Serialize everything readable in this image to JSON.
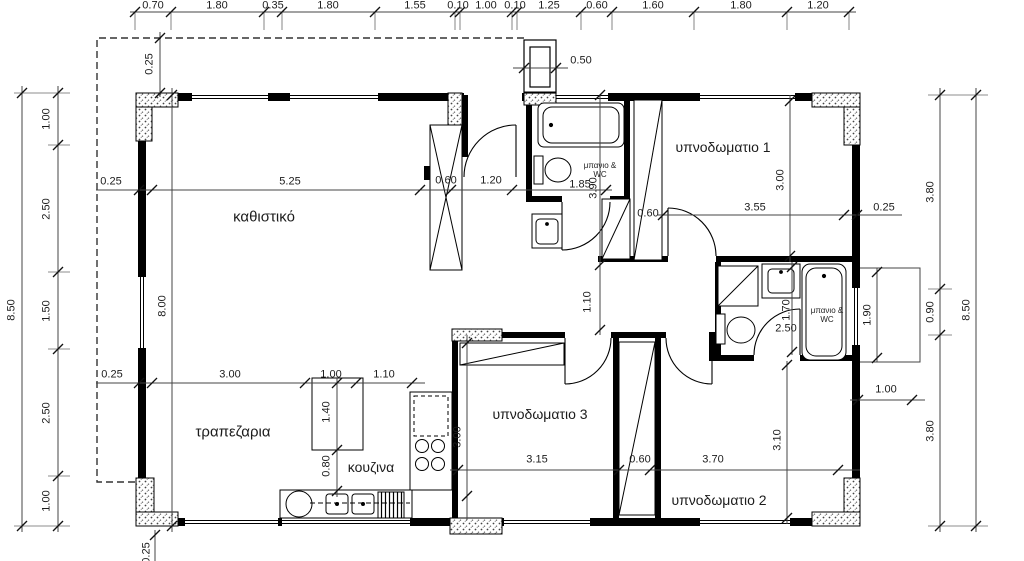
{
  "drawing": {
    "kind": "floor-plan",
    "language": "greek"
  },
  "room_labels": [
    {
      "t": "καθιστικό",
      "x": 264,
      "y": 217,
      "s": 15
    },
    {
      "t": "τραπεζαρια",
      "x": 233,
      "y": 432,
      "s": 15
    },
    {
      "t": "κουζινα",
      "x": 371,
      "y": 467,
      "s": 14
    },
    {
      "t": "υπνοδωματιο 1",
      "x": 723,
      "y": 147,
      "s": 14
    },
    {
      "t": "υπνοδωματιο 2",
      "x": 719,
      "y": 500,
      "s": 14
    },
    {
      "t": "υπνοδωματιο 3",
      "x": 540,
      "y": 414,
      "s": 14
    },
    {
      "t": "μπανιο & WC",
      "x": 600,
      "y": 170,
      "s": 8,
      "w": 46
    },
    {
      "t": "μπανιο & WC",
      "x": 827,
      "y": 315,
      "s": 8,
      "w": 46
    }
  ],
  "dimension_labels": {
    "top_chain": [
      {
        "t": "0.70",
        "x": 153,
        "y": 6
      },
      {
        "t": "1.80",
        "x": 217,
        "y": 6
      },
      {
        "t": "0.35",
        "x": 273,
        "y": 6
      },
      {
        "t": "1.80",
        "x": 328,
        "y": 6
      },
      {
        "t": "1.55",
        "x": 415,
        "y": 6
      },
      {
        "t": "0.10",
        "x": 458,
        "y": 6
      },
      {
        "t": "1.00",
        "x": 486,
        "y": 6
      },
      {
        "t": "0.10",
        "x": 515,
        "y": 6
      },
      {
        "t": "1.25",
        "x": 549,
        "y": 6
      },
      {
        "t": "0.60",
        "x": 597,
        "y": 6
      },
      {
        "t": "1.60",
        "x": 653,
        "y": 6
      },
      {
        "t": "1.80",
        "x": 741,
        "y": 6
      },
      {
        "t": "1.20",
        "x": 818,
        "y": 6
      }
    ],
    "left_chains": [
      {
        "t": "8.50",
        "x": 12,
        "y": 310,
        "rot": 1
      },
      {
        "t": "1.00",
        "x": 47,
        "y": 119,
        "rot": 1
      },
      {
        "t": "2.50",
        "x": 47,
        "y": 209,
        "rot": 1
      },
      {
        "t": "1.50",
        "x": 47,
        "y": 311,
        "rot": 1
      },
      {
        "t": "2.50",
        "x": 47,
        "y": 413,
        "rot": 1
      },
      {
        "t": "1.00",
        "x": 47,
        "y": 501,
        "rot": 1
      }
    ],
    "right_chains": [
      {
        "t": "3.80",
        "x": 931,
        "y": 192,
        "rot": 1
      },
      {
        "t": "0.90",
        "x": 931,
        "y": 312,
        "rot": 1
      },
      {
        "t": "3.80",
        "x": 931,
        "y": 431,
        "rot": 1
      },
      {
        "t": "8.50",
        "x": 967,
        "y": 310,
        "rot": 1
      }
    ],
    "interior": [
      {
        "t": "0.25",
        "x": 150,
        "y": 64,
        "rot": 1
      },
      {
        "t": "0.50",
        "x": 581,
        "y": 61
      },
      {
        "t": "0.25",
        "x": 111,
        "y": 182
      },
      {
        "t": "5.25",
        "x": 290,
        "y": 182
      },
      {
        "t": "0.60",
        "x": 446,
        "y": 181
      },
      {
        "t": "1.20",
        "x": 491,
        "y": 181
      },
      {
        "t": "1.85",
        "x": 580,
        "y": 185
      },
      {
        "t": "3.90",
        "x": 594,
        "y": 188,
        "rot": 1
      },
      {
        "t": "0.60",
        "x": 648,
        "y": 214
      },
      {
        "t": "3.55",
        "x": 755,
        "y": 208
      },
      {
        "t": "0.25",
        "x": 884,
        "y": 208
      },
      {
        "t": "3.00",
        "x": 781,
        "y": 180,
        "rot": 1
      },
      {
        "t": "8.00",
        "x": 163,
        "y": 306,
        "rot": 1
      },
      {
        "t": "1.10",
        "x": 588,
        "y": 302,
        "rot": 1
      },
      {
        "t": "1.70",
        "x": 787,
        "y": 310,
        "rot": 1
      },
      {
        "t": "2.50",
        "x": 786,
        "y": 329
      },
      {
        "t": "1.90",
        "x": 868,
        "y": 315,
        "rot": 1
      },
      {
        "t": "1.00",
        "x": 886,
        "y": 390
      },
      {
        "t": "0.25",
        "x": 112,
        "y": 375
      },
      {
        "t": "3.00",
        "x": 230,
        "y": 375
      },
      {
        "t": "1.00",
        "x": 331,
        "y": 375
      },
      {
        "t": "1.10",
        "x": 384,
        "y": 375
      },
      {
        "t": "1.40",
        "x": 327,
        "y": 412,
        "rot": 1
      },
      {
        "t": "0.80",
        "x": 327,
        "y": 466,
        "rot": 1
      },
      {
        "t": "3.00",
        "x": 458,
        "y": 437,
        "rot": 1
      },
      {
        "t": "3.15",
        "x": 537,
        "y": 460
      },
      {
        "t": "0.60",
        "x": 640,
        "y": 460
      },
      {
        "t": "3.70",
        "x": 713,
        "y": 460
      },
      {
        "t": "3.10",
        "x": 778,
        "y": 440,
        "rot": 1
      },
      {
        "t": "0.25",
        "x": 147,
        "y": 553,
        "rot": 1
      }
    ]
  }
}
